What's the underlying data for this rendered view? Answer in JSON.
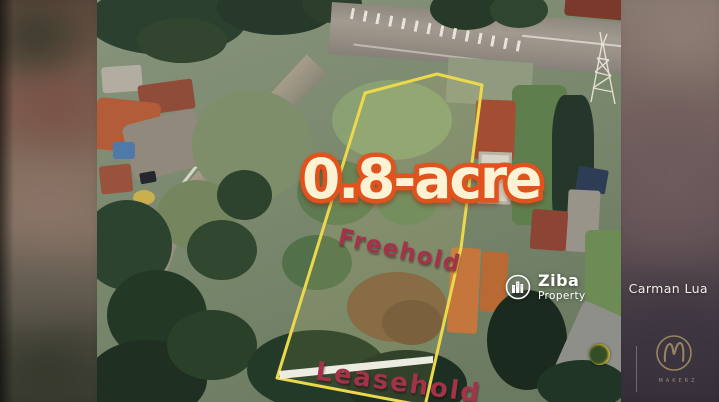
{
  "property": {
    "area_label": "0.8-acre",
    "tenure_main": "Freehold",
    "tenure_front": "Leasehold"
  },
  "branding": {
    "name": "Ziba",
    "subtitle": "Property",
    "icon": "city-buildings-icon"
  },
  "agent": {
    "name": "Carman Lua"
  },
  "producer_logo": {
    "monogram": "M",
    "caption": "MAKERZ",
    "icon": "circle-monogram-icon"
  },
  "map_icons": {
    "pylon": "transmission-tower-icon",
    "crosswalk": "road-hatch-markings",
    "mini_logo": "secondary-circle-logo-icon"
  },
  "colors": {
    "plot_boundary": "#ecd84c",
    "area_text_fill": "#fcf2d4",
    "area_text_outline": "#e2521c",
    "tenure_text": "#a23348",
    "watermark_text": "#ffffff",
    "frontage_strip": "#f5f4ec"
  }
}
